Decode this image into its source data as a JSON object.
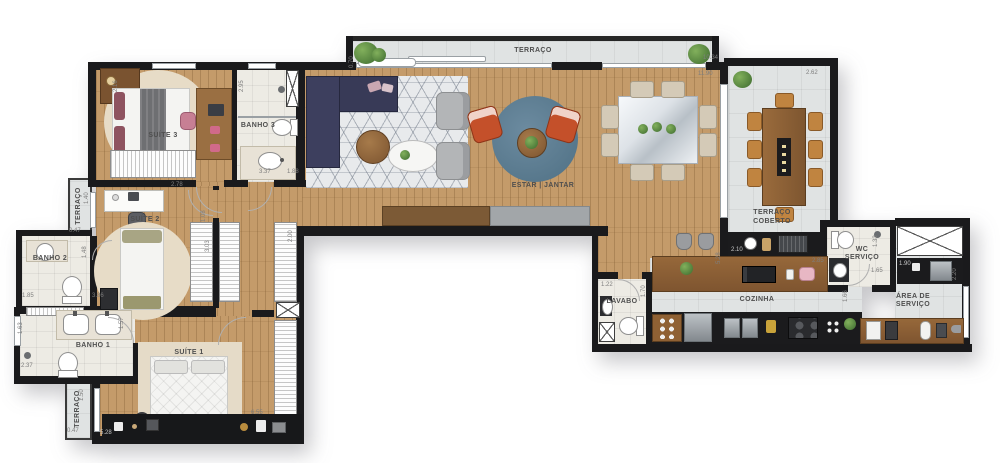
{
  "plan": {
    "rooms": {
      "terraco_top": "TERRAÇO",
      "estar_jantar": "ESTAR | JANTAR",
      "terraco_coberto_1": "TERRAÇO",
      "terraco_coberto_2": "COBERTO",
      "suite3": "SUÍTE 3",
      "banho3": "BANHO 3",
      "suite2": "SUÍTE 2",
      "terraco_mid": "TERRAÇO",
      "banho2": "BANHO 2",
      "banho1": "BANHO 1",
      "suite1": "SUÍTE 1",
      "terraco_bottom": "TERRAÇO",
      "lavabo": "LAVABO",
      "cozinha": "COZINHA",
      "wc_1": "WC",
      "wc_2": "SERVIÇO",
      "area_1": "ÁREA DE",
      "area_2": "SERVIÇO"
    },
    "dimensions": [
      {
        "v": "0.70",
        "x": 349,
        "y": 68,
        "r": 1
      },
      {
        "v": "10.34",
        "x": 703,
        "y": 55,
        "r": 0
      },
      {
        "v": "11.90",
        "x": 698,
        "y": 71,
        "r": 0
      },
      {
        "v": "2.62",
        "x": 806,
        "y": 70,
        "r": 0
      },
      {
        "v": "2.16",
        "x": 113,
        "y": 92,
        "r": 1
      },
      {
        "v": "2.95",
        "x": 239,
        "y": 92,
        "r": 1
      },
      {
        "v": "3.37",
        "x": 259,
        "y": 169,
        "r": 0
      },
      {
        "v": "1.88",
        "x": 287,
        "y": 169,
        "r": 0
      },
      {
        "v": "2.78",
        "x": 171,
        "y": 182,
        "r": 0
      },
      {
        "v": "1.40",
        "x": 84,
        "y": 204,
        "r": 1
      },
      {
        "v": "0.47",
        "x": 69,
        "y": 228,
        "r": 0
      },
      {
        "v": "1.48",
        "x": 82,
        "y": 258,
        "r": 1
      },
      {
        "v": "1.08",
        "x": 201,
        "y": 222,
        "r": 1
      },
      {
        "v": "3.03",
        "x": 205,
        "y": 252,
        "r": 1
      },
      {
        "v": "2.00",
        "x": 288,
        "y": 242,
        "r": 1
      },
      {
        "v": "1.85",
        "x": 22,
        "y": 293,
        "r": 0
      },
      {
        "v": "3.86",
        "x": 92,
        "y": 293,
        "r": 0
      },
      {
        "v": "1.57",
        "x": 119,
        "y": 329,
        "r": 1
      },
      {
        "v": "1.63",
        "x": 18,
        "y": 334,
        "r": 1
      },
      {
        "v": "2.37",
        "x": 21,
        "y": 363,
        "r": 0
      },
      {
        "v": "1.50",
        "x": 79,
        "y": 401,
        "r": 1
      },
      {
        "v": "0.47",
        "x": 67,
        "y": 428,
        "r": 0
      },
      {
        "v": "5.28",
        "x": 100,
        "y": 430,
        "r": 0,
        "light": true
      },
      {
        "v": "6.55",
        "x": 251,
        "y": 410,
        "r": 0
      },
      {
        "v": "2.10",
        "x": 731,
        "y": 247,
        "r": 0,
        "light": true
      },
      {
        "v": "5.28",
        "x": 716,
        "y": 264,
        "r": 1
      },
      {
        "v": "2.85",
        "x": 812,
        "y": 258,
        "r": 0
      },
      {
        "v": "1.22",
        "x": 601,
        "y": 282,
        "r": 0
      },
      {
        "v": "1.70",
        "x": 641,
        "y": 297,
        "r": 1
      },
      {
        "v": "1.33",
        "x": 873,
        "y": 247,
        "r": 1
      },
      {
        "v": "1.65",
        "x": 871,
        "y": 268,
        "r": 0
      },
      {
        "v": "1.90",
        "x": 899,
        "y": 261,
        "r": 0,
        "light": true
      },
      {
        "v": "2.20",
        "x": 952,
        "y": 280,
        "r": 1
      },
      {
        "v": "1.66",
        "x": 843,
        "y": 302,
        "r": 1
      }
    ],
    "colors": {
      "wall": "#1a1a1c",
      "wood_floor": "#c49b6a",
      "terrace_tile": "#e0e3e3",
      "sofa_navy": "#383a57",
      "accent_chair": "#c4502a",
      "blue_rug": "#4f7084",
      "counter_black": "#1b1b1d",
      "furniture_wood": "#8f6134"
    }
  }
}
